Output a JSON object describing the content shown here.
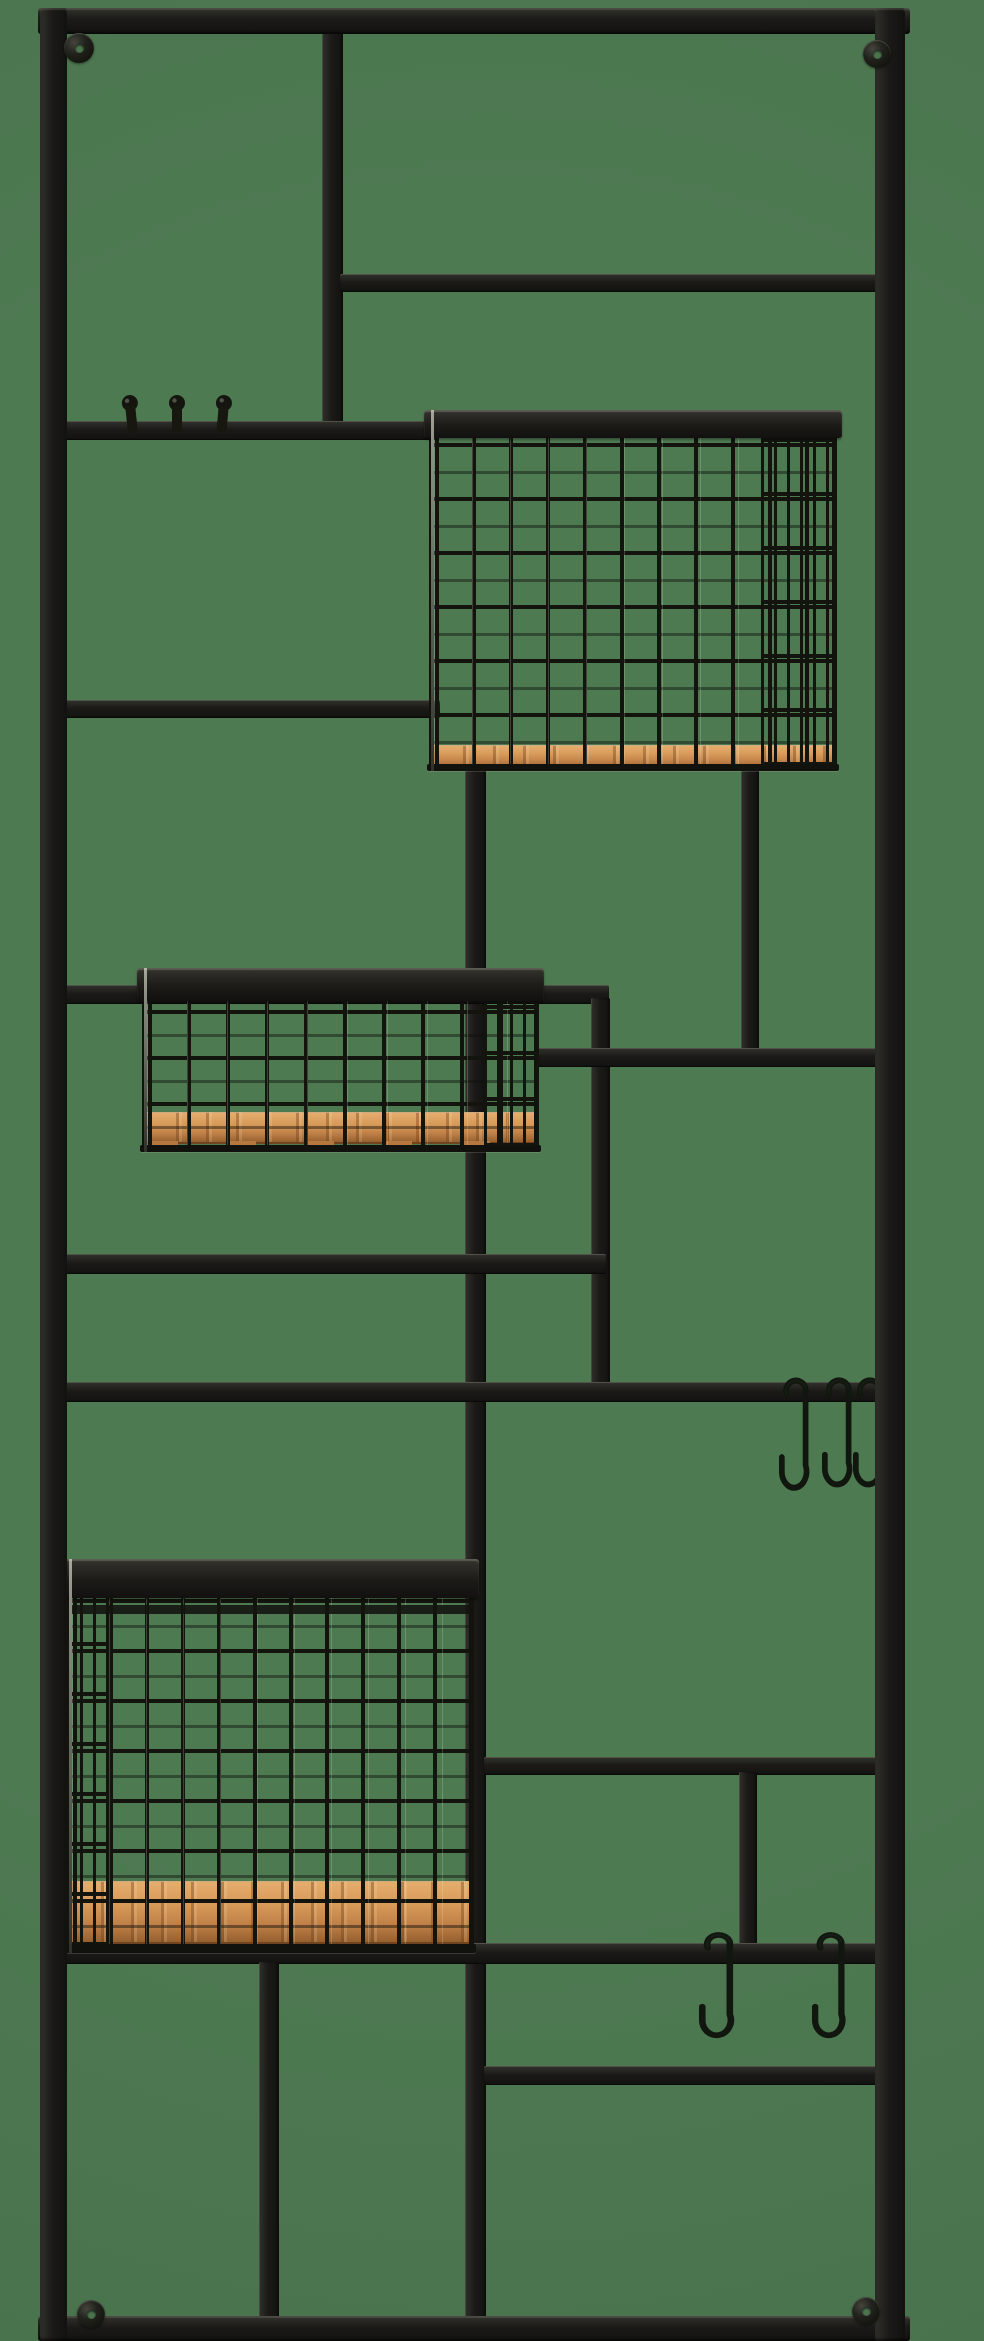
{
  "scene": {
    "label": "Black metal wall-mounted organizer rack with wire mesh baskets, wooden shelf bases, peg hooks and S-hooks, photographed on a green background",
    "canvas": {
      "width": 984,
      "height": 2341
    },
    "colors": {
      "background": "#4e7a52",
      "metal_dark": "#15150f",
      "metal_mid": "#1b1a17",
      "metal_highlight": "#bcc8b0",
      "wood_light": "#e5ad6e",
      "wood_mid": "#cf9254",
      "wood_dark": "#96602f",
      "wire": "#14140f"
    }
  },
  "bars": [
    {
      "name": "frame-top-bar",
      "o": "h",
      "frame": true,
      "x": 38,
      "y": 8,
      "w": 872,
      "h": 26
    },
    {
      "name": "frame-bottom-bar",
      "o": "h",
      "frame": true,
      "x": 38,
      "y": 2316,
      "w": 872,
      "h": 25
    },
    {
      "name": "frame-left-bar",
      "o": "v",
      "frame": true,
      "x": 40,
      "y": 8,
      "w": 27,
      "h": 2333
    },
    {
      "name": "frame-right-bar",
      "o": "v",
      "frame": true,
      "x": 875,
      "y": 8,
      "w": 30,
      "h": 2333
    },
    {
      "name": "top-divider-bar",
      "o": "v",
      "x": 322,
      "y": 30,
      "w": 21,
      "h": 402
    },
    {
      "name": "upper-right-shelf-bar",
      "o": "h",
      "x": 340,
      "y": 274,
      "w": 537,
      "h": 18
    },
    {
      "name": "peg-hook-rail",
      "o": "h",
      "x": 64,
      "y": 421,
      "w": 375,
      "h": 19
    },
    {
      "name": "left-mid-shelf-bar",
      "o": "h",
      "x": 64,
      "y": 700,
      "w": 376,
      "h": 18
    },
    {
      "name": "long-center-vertical-bar",
      "o": "v",
      "x": 465,
      "y": 762,
      "w": 21,
      "h": 1560
    },
    {
      "name": "under-basket1-vertical-bar",
      "o": "v",
      "x": 741,
      "y": 762,
      "w": 18,
      "h": 298
    },
    {
      "name": "basket2-rail-bar",
      "o": "h",
      "x": 64,
      "y": 985,
      "w": 545,
      "h": 19
    },
    {
      "name": "mid-vertical-bar",
      "o": "v",
      "x": 591,
      "y": 998,
      "w": 19,
      "h": 402
    },
    {
      "name": "right-mid-shelf-bar",
      "o": "h",
      "x": 537,
      "y": 1048,
      "w": 341,
      "h": 19
    },
    {
      "name": "left-lower-shelf-bar",
      "o": "h",
      "x": 64,
      "y": 1254,
      "w": 542,
      "h": 20
    },
    {
      "name": "s-hook-rail-bar",
      "o": "h",
      "x": 64,
      "y": 1382,
      "w": 813,
      "h": 20
    },
    {
      "name": "lower-right-shelf-bar",
      "o": "h",
      "x": 484,
      "y": 1757,
      "w": 393,
      "h": 18
    },
    {
      "name": "lower-right-vertical-bar",
      "o": "v",
      "x": 739,
      "y": 1772,
      "w": 18,
      "h": 178
    },
    {
      "name": "full-width-lower-bar",
      "o": "h",
      "x": 64,
      "y": 1943,
      "w": 813,
      "h": 21
    },
    {
      "name": "bottom-right-shelf-bar",
      "o": "h",
      "x": 484,
      "y": 2066,
      "w": 393,
      "h": 19
    },
    {
      "name": "bottom-left-vertical-bar",
      "o": "v",
      "x": 259,
      "y": 1962,
      "w": 20,
      "h": 360
    }
  ],
  "baskets": [
    {
      "name": "wire-basket-top-right",
      "x": 429,
      "y": 410,
      "w": 408,
      "h": 361,
      "rail_h": 28,
      "rail2_y": 0,
      "wood_y": 335,
      "wood_h": 22,
      "tabs_h": 0,
      "mesh_v": 38,
      "mesh_h": 54,
      "rim_h": 7,
      "side": "right",
      "side_w": 76
    },
    {
      "name": "wire-basket-middle-left",
      "x": 142,
      "y": 968,
      "w": 397,
      "h": 184,
      "rail_h": 33,
      "rail2_y": 0,
      "wood_y": 144,
      "wood_h": 29,
      "tabs_h": 10,
      "mesh_v": 40,
      "mesh_h": 46,
      "rim_h": 7,
      "side": "right",
      "side_w": 55
    },
    {
      "name": "wire-basket-bottom-left",
      "x": 67,
      "y": 1559,
      "w": 407,
      "h": 394,
      "rail_h": 39,
      "rail2_y": 46,
      "wood_y": 322,
      "wood_h": 60,
      "tabs_h": 0,
      "mesh_v": 37,
      "mesh_h": 50,
      "rim_h": 9,
      "side": "left",
      "side_w": 42
    }
  ],
  "peg_hooks": [
    {
      "name": "peg-hook-1",
      "x": 118,
      "y": 394,
      "w": 26,
      "h": 40,
      "tilt": -6
    },
    {
      "name": "peg-hook-2",
      "x": 164,
      "y": 394,
      "w": 26,
      "h": 40,
      "tilt": 0
    },
    {
      "name": "peg-hook-3",
      "x": 210,
      "y": 394,
      "w": 26,
      "h": 40,
      "tilt": 5
    }
  ],
  "s_hooks": [
    {
      "name": "s-hook-middle-1",
      "x": 779,
      "y": 1370,
      "w": 38,
      "h": 142
    },
    {
      "name": "s-hook-middle-2",
      "x": 822,
      "y": 1370,
      "w": 38,
      "h": 138
    },
    {
      "name": "s-hook-middle-3",
      "x": 853,
      "y": 1370,
      "w": 38,
      "h": 138
    },
    {
      "name": "s-hook-bottom-1",
      "x": 699,
      "y": 1925,
      "w": 44,
      "h": 133
    },
    {
      "name": "s-hook-bottom-2",
      "x": 812,
      "y": 1925,
      "w": 42,
      "h": 133
    }
  ],
  "screws": [
    {
      "name": "mounting-screw-top-left",
      "x": 79,
      "y": 48,
      "r": 15
    },
    {
      "name": "mounting-screw-top-right",
      "x": 877,
      "y": 54,
      "r": 14
    },
    {
      "name": "mounting-screw-bottom-left",
      "x": 91,
      "y": 2314,
      "r": 14
    },
    {
      "name": "mounting-screw-bottom-right",
      "x": 866,
      "y": 2311,
      "r": 14
    }
  ]
}
